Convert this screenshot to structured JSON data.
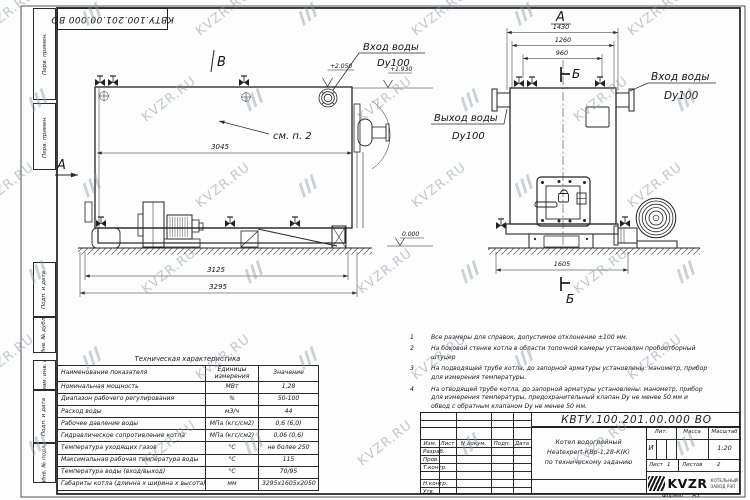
{
  "watermark": {
    "text": "KVZR.RU"
  },
  "stamp_top": {
    "text": "КВТУ.100.201.00.000 ВО"
  },
  "sidebar": {
    "cells": [
      "Перв. примен.",
      "Перв. примен.",
      "Подп. и дата",
      "Инв. № дубл.",
      "Взам. инв. №",
      "Подп. и дата",
      "Инв. № подл."
    ]
  },
  "views": {
    "side": {
      "view_label": "В",
      "arrow_label": "А",
      "see_note": "см. п. 2",
      "dim_inner": "3045",
      "dim_mid": "3125",
      "dim_overall": "3295",
      "elev_top": "+2.050",
      "elev_nozzle": "+1.930",
      "elev_zero": "0.000",
      "inlet_label": "Вход воды",
      "inlet_dn": "Dy100"
    },
    "front": {
      "view_label": "А",
      "section_label_top": "Б",
      "section_label_bottom": "Б",
      "dim_overall": "1430",
      "dim_body": "1260",
      "dim_nozzles": "960",
      "dim_width": "1605",
      "outlet_label": "Выход воды",
      "outlet_dn": "Dy100",
      "inlet_label": "Вход воды",
      "inlet_dn": "Dy100"
    }
  },
  "tech_table": {
    "title": "Техническая характеристика",
    "headers": [
      "Наименование показателя",
      "Единицы измерения",
      "Значение"
    ],
    "rows": [
      [
        "Номинальная мощность",
        "МВт",
        "1,28"
      ],
      [
        "Диапазон рабочего регулирования",
        "%",
        "50-100"
      ],
      [
        "Расход воды",
        "м3/ч",
        "44"
      ],
      [
        "Рабочее давление воды",
        "МПа (кгс/см2)",
        "0,6 (6,0)"
      ],
      [
        "Гидравлическое сопротивление котла",
        "МПа (кгс/см2)",
        "0,06 (0,6)"
      ],
      [
        "Температура уходящих газов",
        "°С",
        "не более 250"
      ],
      [
        "Максимальная рабочая температура воды",
        "°С",
        "115"
      ],
      [
        "Температура воды (вход/выход)",
        "°С",
        "70/95"
      ],
      [
        "Габариты котла (длинна х ширина х высота)",
        "мм",
        "3295х1605х2050"
      ]
    ]
  },
  "notes": {
    "items": [
      {
        "num": "1",
        "text": "Все размеры для справок, допустимое отклонение ±100 мм."
      },
      {
        "num": "2",
        "text": "На боковой стенке котла в области топочной камеры установлен пробоотборный штуцер"
      },
      {
        "num": "3",
        "text": "На подводящей трубе котла, до запорной арматуры установлены: манометр, прибор для измерения температуры."
      },
      {
        "num": "4",
        "text": "На отводящей трубе котла, до запорной арматуры установлены: манометр, прибор для измерения температуры, предохранительный клапан Dу не менее 50 мм и обвод с обратным клапаном Dу не менее 50 мм."
      }
    ]
  },
  "title_block": {
    "doc_number": "КВТУ.100.201.00.000 ВО",
    "col_izm": "Изм.",
    "col_list": "Лист",
    "col_ndoc": "N докум.",
    "col_podp": "Подп.",
    "col_data": "Дата",
    "row_razrab": "Разраб.",
    "row_prov": "Пров.",
    "row_tkontr": "Т.контр.",
    "row_nkontr": "Н.контр.",
    "row_utv": "Утв.",
    "title_line1": "Котел водогрейный",
    "title_line2": "Heatexpert-КВр-1,28-К(К)",
    "title_line3": "по техническому заданию",
    "lit_header": "Лит.",
    "mass_header": "Масса",
    "scale_header": "Масштаб",
    "lit_value": "И",
    "scale_value": "1:20",
    "sheet_label": "Лист",
    "sheet_value": "1",
    "sheets_label": "Листов",
    "sheets_value": "2",
    "logo_text": "KVZR",
    "logo_sub1": "КОТЕЛЬНЫЙ",
    "logo_sub2": "ЗАВОД РЭП",
    "format_label": "Формат",
    "format_value": "А3"
  }
}
